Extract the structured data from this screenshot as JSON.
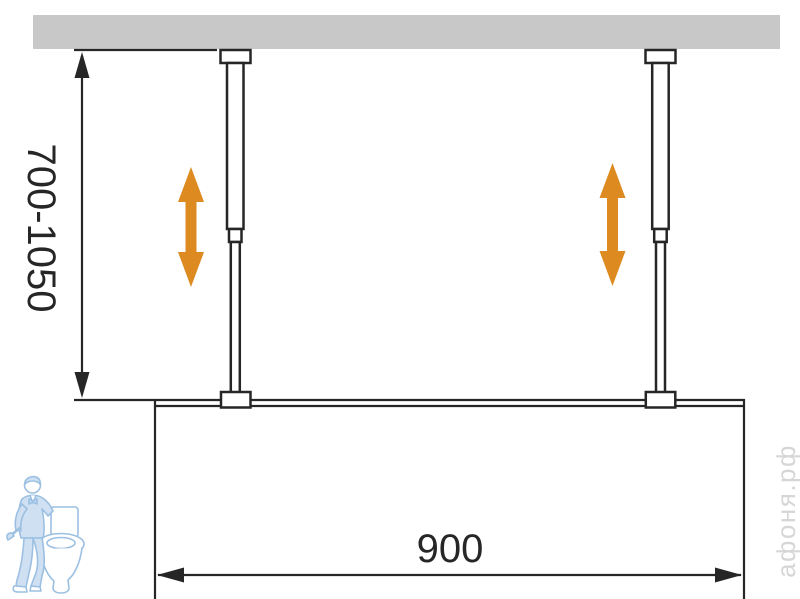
{
  "colors": {
    "background": "#ffffff",
    "ceiling": "#c8c8c8",
    "line": "#262626",
    "arrow": "#dd8b20",
    "watermark-text": "#d6d6d6",
    "watermark-stroke": "#9cc0e2",
    "watermark-fill": "#cfe0f2"
  },
  "dimensions": {
    "height_range": "700-1050",
    "width": "900"
  },
  "watermark": {
    "site": "афоня.рф",
    "logo": "plumber-with-toilet-logo"
  }
}
